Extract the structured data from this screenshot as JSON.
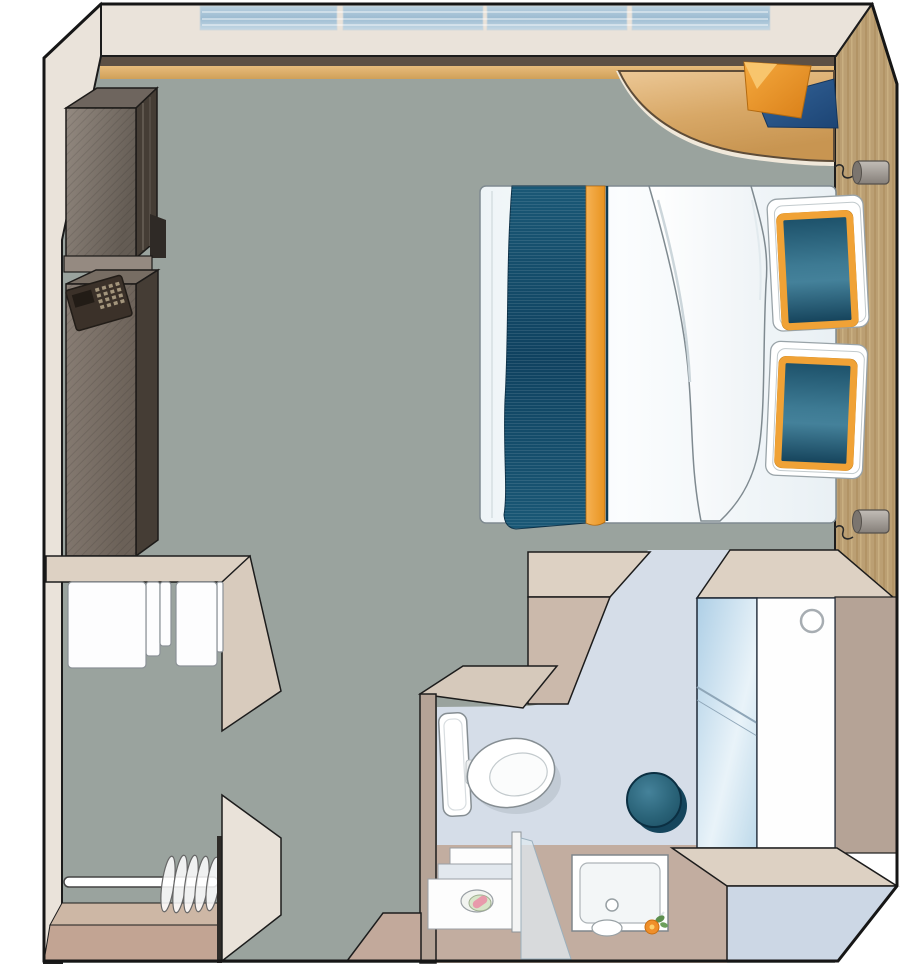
{
  "meta": {
    "title": "Cruise cabin floor plan (top-down illustration)",
    "type": "floor-plan",
    "text_visible": "none"
  },
  "palette": {
    "floor": "#9aa39e",
    "bathFloor": "#d5dde8",
    "cream": "#eae3da",
    "beigeTop": "#ddd1c3",
    "beigeFront": "#cbb9ab",
    "beigeMid": "#d6c9bb",
    "taupe": "#b5a396",
    "taupeSoft": "#c2ada0",
    "taupeWedge": "#c2a99b",
    "closetTanLight": "#cdb7a5",
    "closetTan": "#c2a493",
    "doorBlue": "#ccd7e5",
    "panelCream": "#e9e2d9",
    "white": "#ffffff",
    "darkStrip": "#5d5044",
    "woodBase": "#bb9f73",
    "cabTop": "#6e655e",
    "cabSide": "#453d35",
    "cabFoot": "#2f2a26",
    "pedestal": "#958a81",
    "safeTop": "#776d63",
    "keypadBody": "#3b3129",
    "keypadScreen": "#221c16",
    "keypadButton": "#a3957c",
    "navyRunner": "#12486a",
    "orangeTrim": "#f0a236",
    "pillowTeal": "#2a6a85",
    "stoolTeal": "#2f6d82",
    "stoolShadow": "#15455c",
    "edgeBar": "#2e2b28",
    "outline": "#1c1c1c",
    "fixtureOutline": "#868e93"
  },
  "items": {
    "window_band": {
      "label": "panoramic window band",
      "panes": 4
    },
    "desk": {
      "label": "corner desk with papers"
    },
    "papers": {
      "label": "orange and blue papers on desk"
    },
    "lamp_top": {
      "label": "wall reading lamp (top)"
    },
    "lamp_bottom": {
      "label": "wall reading lamp (bottom)"
    },
    "tv_cabinet": {
      "label": "TV cabinet unit"
    },
    "safe": {
      "label": "safe with keypad"
    },
    "bed": {
      "label": "double bed with runner and folded duvet"
    },
    "pillows": {
      "label": "two pillows with teal panels",
      "count": 2
    },
    "headboard_wall": {
      "label": "wood headboard wall"
    },
    "wardrobe": {
      "label": "wardrobe with white door panels"
    },
    "closet": {
      "label": "closet with hanger rod",
      "hangers": 5
    },
    "bathroom": {
      "label": "bathroom"
    },
    "toilet": {
      "label": "toilet"
    },
    "stool": {
      "label": "teal stool / basin"
    },
    "vanity": {
      "label": "vanity counter with soap dish"
    },
    "shower": {
      "label": "shower tray with glass partition"
    },
    "bath_door": {
      "label": "bathroom door with glass panel"
    },
    "entrance_door": {
      "label": "entrance door (open)"
    }
  }
}
